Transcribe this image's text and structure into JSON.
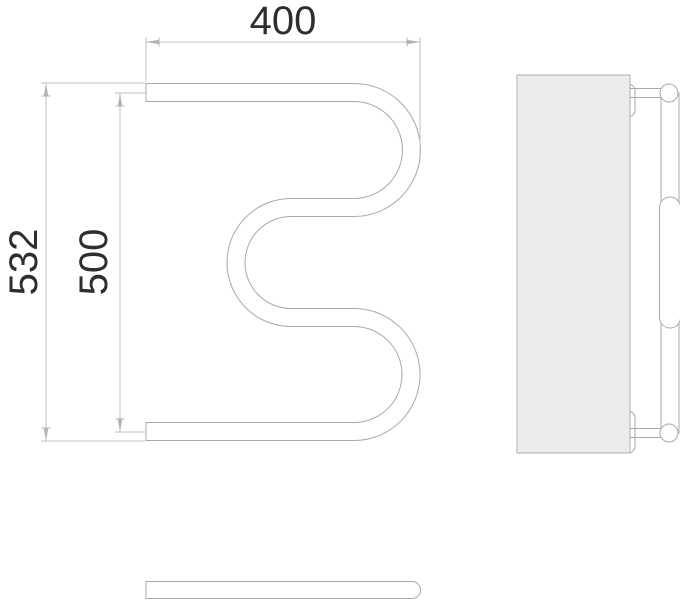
{
  "drawing": {
    "dimensions": {
      "width": "400",
      "height_overall": "532",
      "height_axis": "500"
    },
    "colors": {
      "background": "#ffffff",
      "line": "#a9a9a9",
      "dim_line": "#c0c0c0",
      "arrow": "#b3b3b3",
      "text": "#2e2e2e",
      "panel_fill": "#ececec",
      "panel_stroke": "#b0b0b0"
    }
  }
}
